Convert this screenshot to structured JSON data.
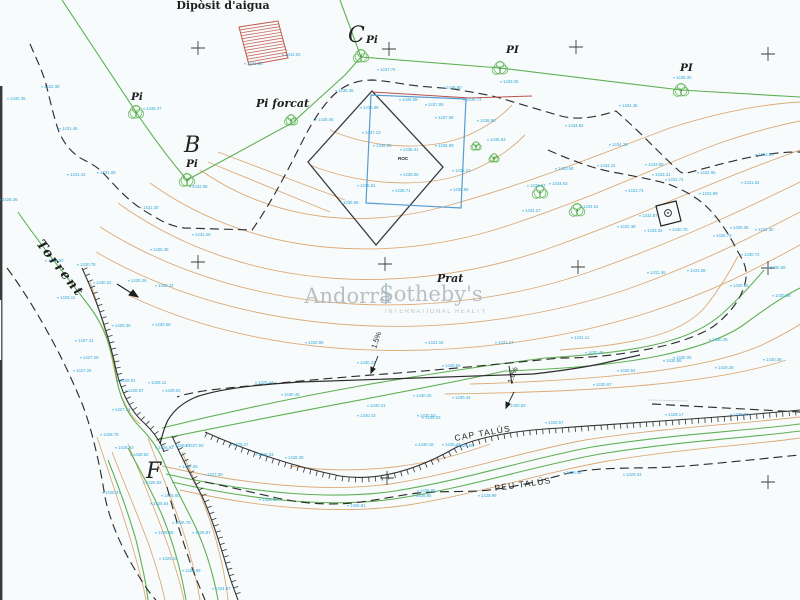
{
  "map": {
    "place_labels": {
      "diposit": "Dipòsit d'aigua",
      "pi_forcat": "Pi forcat",
      "torrent": "Torrent",
      "prat": "Prat",
      "roc": "ROC",
      "cap_talus": "CAP TALÚS",
      "peu_talus": "PEU TALÚS",
      "slope1": "1.5%",
      "slope2": "1.0%"
    },
    "watermark": {
      "left": "Andorra",
      "right": "Sotheby's",
      "tagline": "INTERNATIONAL REALTY"
    },
    "letters": [
      {
        "t": "B",
        "x": 184,
        "y": 152
      },
      {
        "t": "C",
        "x": 348,
        "y": 42
      },
      {
        "t": "F",
        "x": 146,
        "y": 478
      }
    ],
    "pi_labels": [
      {
        "t": "Pi",
        "x": 131,
        "y": 100
      },
      {
        "t": "Pi",
        "x": 186,
        "y": 167
      },
      {
        "t": "Pi",
        "x": 366,
        "y": 43
      },
      {
        "t": "PI",
        "x": 506,
        "y": 53
      },
      {
        "t": "PI",
        "x": 680,
        "y": 71
      }
    ],
    "crosses": [
      [
        198,
        48
      ],
      [
        389,
        49
      ],
      [
        576,
        47
      ],
      [
        768,
        54
      ],
      [
        198,
        262
      ],
      [
        385,
        264
      ],
      [
        578,
        267
      ],
      [
        768,
        268
      ],
      [
        387,
        478
      ],
      [
        768,
        482
      ]
    ],
    "trees": [
      {
        "x": 136,
        "y": 112,
        "r": 6
      },
      {
        "x": 187,
        "y": 180,
        "r": 6
      },
      {
        "x": 291,
        "y": 120,
        "r": 5
      },
      {
        "x": 361,
        "y": 56,
        "r": 6
      },
      {
        "x": 500,
        "y": 68,
        "r": 6
      },
      {
        "x": 681,
        "y": 90,
        "r": 6
      },
      {
        "x": 476,
        "y": 146,
        "r": 4
      },
      {
        "x": 494,
        "y": 158,
        "r": 4
      },
      {
        "x": 540,
        "y": 192,
        "r": 6
      },
      {
        "x": 577,
        "y": 210,
        "r": 6
      }
    ],
    "elevations": [
      [
        10,
        100,
        "1432.35"
      ],
      [
        44,
        88,
        "1432.38"
      ],
      [
        62,
        130,
        "1431.46"
      ],
      [
        146,
        110,
        "1435.47"
      ],
      [
        70,
        176,
        "1431.42"
      ],
      [
        100,
        174,
        "1431.08"
      ],
      [
        143,
        209,
        "1431.30"
      ],
      [
        195,
        236,
        "1431.26"
      ],
      [
        153,
        251,
        "1430.48"
      ],
      [
        80,
        266,
        "1430.78"
      ],
      [
        48,
        262,
        "1429.50"
      ],
      [
        96,
        284,
        "1430.22"
      ],
      [
        131,
        282,
        "1430.26"
      ],
      [
        158,
        287,
        "1430.24"
      ],
      [
        60,
        299,
        "1428.11"
      ],
      [
        115,
        327,
        "1428.35"
      ],
      [
        155,
        326,
        "1430.55"
      ],
      [
        78,
        342,
        "1427.41"
      ],
      [
        83,
        359,
        "1427.28"
      ],
      [
        76,
        372,
        "1427.26"
      ],
      [
        2,
        201,
        "1428.36"
      ],
      [
        192,
        188,
        "1432.98"
      ],
      [
        120,
        382,
        "1428.91"
      ],
      [
        151,
        384,
        "1428.11"
      ],
      [
        128,
        392,
        "1428.87"
      ],
      [
        165,
        392,
        "1429.02"
      ],
      [
        258,
        384,
        "1428.44"
      ],
      [
        115,
        411,
        "1427.14"
      ],
      [
        103,
        436,
        "1428.78"
      ],
      [
        118,
        449,
        "1428.93"
      ],
      [
        133,
        456,
        "1428.82"
      ],
      [
        158,
        449,
        "1426.92"
      ],
      [
        175,
        447,
        "1426.97"
      ],
      [
        188,
        447,
        "1427.93"
      ],
      [
        182,
        468,
        "1427.05"
      ],
      [
        207,
        476,
        "1427.30"
      ],
      [
        146,
        484,
        "1426.82"
      ],
      [
        105,
        494,
        "1428.37"
      ],
      [
        153,
        505,
        "1425.54"
      ],
      [
        164,
        497,
        "1425.60"
      ],
      [
        175,
        524,
        "1426.78"
      ],
      [
        158,
        534,
        "1425.58"
      ],
      [
        195,
        534,
        "1426.87"
      ],
      [
        162,
        560,
        "1425.16"
      ],
      [
        185,
        572,
        "1424.98"
      ],
      [
        215,
        590,
        "1424.87"
      ],
      [
        233,
        446,
        "1428.27"
      ],
      [
        258,
        456,
        "1428.34"
      ],
      [
        288,
        459,
        "1428.28"
      ],
      [
        380,
        71,
        "1437.76"
      ],
      [
        338,
        92,
        "1438.36"
      ],
      [
        363,
        109,
        "1435.88"
      ],
      [
        402,
        101,
        "1435.68"
      ],
      [
        428,
        106,
        "1437.89"
      ],
      [
        446,
        89,
        "1436.80"
      ],
      [
        466,
        101,
        "1436.74"
      ],
      [
        490,
        141,
        "1436.63"
      ],
      [
        438,
        119,
        "1437.58"
      ],
      [
        480,
        122,
        "1438.80"
      ],
      [
        318,
        121,
        "1435.06"
      ],
      [
        365,
        134,
        "1437.13"
      ],
      [
        376,
        147,
        "1436.86"
      ],
      [
        403,
        151,
        "1436.31"
      ],
      [
        438,
        147,
        "1436.88"
      ],
      [
        455,
        172,
        "1436.23"
      ],
      [
        403,
        176,
        "1436.06"
      ],
      [
        360,
        187,
        "1435.81"
      ],
      [
        395,
        192,
        "1436.71"
      ],
      [
        453,
        191,
        "1435.56"
      ],
      [
        343,
        204,
        "1436.58"
      ],
      [
        503,
        83,
        "1433.36"
      ],
      [
        676,
        79,
        "1438.30"
      ],
      [
        285,
        56,
        "1443.02"
      ],
      [
        247,
        65,
        "1441.58"
      ],
      [
        530,
        187,
        "1434.37"
      ],
      [
        552,
        185,
        "1434.63"
      ],
      [
        583,
        208,
        "1434.51"
      ],
      [
        525,
        212,
        "1434.27"
      ],
      [
        558,
        170,
        "1433.98"
      ],
      [
        620,
        228,
        "1432.38"
      ],
      [
        568,
        127,
        "1434.84"
      ],
      [
        612,
        146,
        "1434.38"
      ],
      [
        600,
        167,
        "1434.24"
      ],
      [
        622,
        107,
        "1434.36"
      ],
      [
        648,
        166,
        "1433.88"
      ],
      [
        655,
        176,
        "1433.31"
      ],
      [
        668,
        181,
        "1432.74"
      ],
      [
        700,
        174,
        "1432.96"
      ],
      [
        758,
        156,
        "1431.89"
      ],
      [
        744,
        184,
        "1431.84"
      ],
      [
        628,
        192,
        "1433.74"
      ],
      [
        702,
        195,
        "1432.98"
      ],
      [
        642,
        217,
        "1432.87"
      ],
      [
        672,
        231,
        "1430.76"
      ],
      [
        647,
        232,
        "1433.32"
      ],
      [
        716,
        237,
        "1430.78"
      ],
      [
        733,
        229,
        "1430.36"
      ],
      [
        758,
        231,
        "1431.30"
      ],
      [
        744,
        256,
        "1430.72"
      ],
      [
        770,
        269,
        "1430.58"
      ],
      [
        690,
        272,
        "1431.08"
      ],
      [
        650,
        274,
        "1431.36"
      ],
      [
        733,
        287,
        "1430.55"
      ],
      [
        775,
        297,
        "1430.88"
      ],
      [
        712,
        341,
        "1430.28"
      ],
      [
        766,
        361,
        "1430.38"
      ],
      [
        676,
        359,
        "1430.08"
      ],
      [
        718,
        369,
        "1429.28"
      ],
      [
        574,
        339,
        "1431.11"
      ],
      [
        588,
        354,
        "1430.46"
      ],
      [
        666,
        362,
        "1430.98"
      ],
      [
        620,
        372,
        "1430.54"
      ],
      [
        596,
        386,
        "1430.97"
      ],
      [
        668,
        416,
        "1428.17"
      ],
      [
        733,
        416,
        "1428.70"
      ],
      [
        308,
        344,
        "1430.96"
      ],
      [
        428,
        344,
        "1431.18"
      ],
      [
        498,
        344,
        "1431.17"
      ],
      [
        360,
        364,
        "1430.22"
      ],
      [
        445,
        367,
        "1430.66"
      ],
      [
        284,
        396,
        "1430.46"
      ],
      [
        416,
        397,
        "1430.26"
      ],
      [
        455,
        399,
        "1430.44"
      ],
      [
        370,
        407,
        "1430.41"
      ],
      [
        360,
        417,
        "1430.43"
      ],
      [
        420,
        417,
        "1430.53"
      ],
      [
        510,
        407,
        "1430.83"
      ],
      [
        418,
        446,
        "1430.18"
      ],
      [
        445,
        446,
        "1429.43"
      ],
      [
        262,
        501,
        "1426.38"
      ],
      [
        350,
        507,
        "1426.81"
      ],
      [
        416,
        497,
        "1426.85"
      ],
      [
        425,
        419,
        "1430.03"
      ],
      [
        458,
        447,
        "1429.96"
      ],
      [
        548,
        424,
        "1430.57"
      ],
      [
        566,
        474,
        "1429.98"
      ],
      [
        626,
        476,
        "1429.34"
      ],
      [
        420,
        492,
        "1428.85"
      ],
      [
        481,
        497,
        "1428.98"
      ]
    ],
    "colors": {
      "contour": "#d8a269",
      "green": "#5fb054",
      "cyan": "#35a8d8",
      "boundary": "#2e2e2e",
      "red": "#c2574a",
      "blue_rect": "#5a9bd0",
      "watermark": "#aeb5ba"
    }
  }
}
